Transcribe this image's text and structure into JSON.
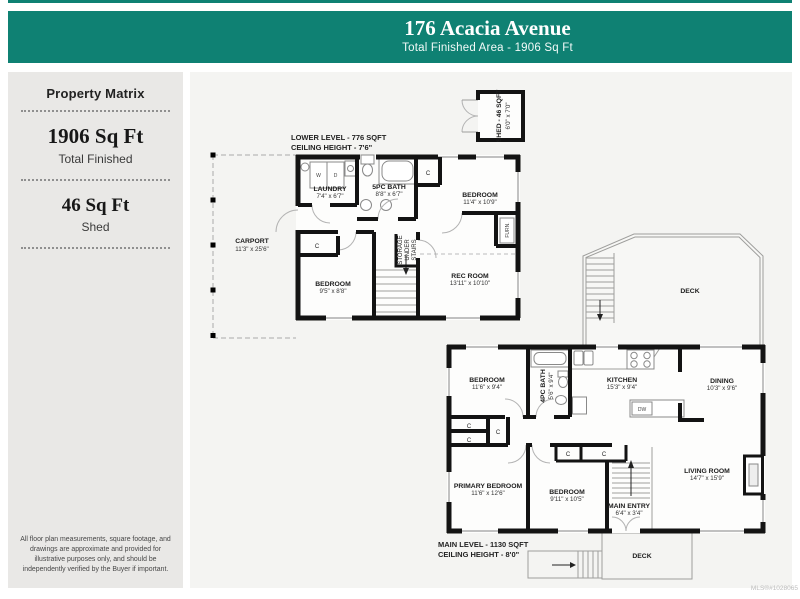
{
  "header": {
    "title": "176 Acacia Avenue",
    "subtitle": "Total Finished Area - 1906 Sq Ft"
  },
  "sidebar": {
    "title": "Property Matrix",
    "stat1_value": "1906 Sq Ft",
    "stat1_label": "Total Finished",
    "stat2_value": "46 Sq Ft",
    "stat2_label": "Shed",
    "disclaimer": "All floor plan measurements, square footage, and drawings are approximate and provided for illustrative purposes only, and should be independently verified by the Buyer if important."
  },
  "shed": {
    "name": "SHED - 46 SQFT",
    "dims": "6'0\" x 7'0\""
  },
  "lower_level": {
    "title": "LOWER LEVEL - 776 SQFT",
    "ceiling": "CEILING HEIGHT - 7'6\"",
    "rooms": {
      "carport": {
        "name": "CARPORT",
        "dims": "11'3\" x 25'6\""
      },
      "laundry": {
        "name": "LAUNDRY",
        "dims": "7'4\" x 6'7\""
      },
      "bath": {
        "name": "5PC BATH",
        "dims": "8'8\" x 6'7\""
      },
      "bedroom1": {
        "name": "BEDROOM",
        "dims": "11'4\" x 10'9\""
      },
      "bedroom2": {
        "name": "BEDROOM",
        "dims": "9'5\" x 8'8\""
      },
      "recroom": {
        "name": "REC ROOM",
        "dims": "13'11\" x 10'10\""
      },
      "storage": {
        "line1": "STORAGE",
        "line2": "UNDER",
        "line3": "STAIRS"
      },
      "furnace": "FURN."
    }
  },
  "main_level": {
    "title": "MAIN LEVEL - 1130 SQFT",
    "ceiling": "CEILING HEIGHT - 8'0\"",
    "rooms": {
      "bedroom1": {
        "name": "BEDROOM",
        "dims": "11'6\" x 9'4\""
      },
      "bath": {
        "name": "4PC BATH",
        "dims": "5'6\" x 9'4\""
      },
      "kitchen": {
        "name": "KITCHEN",
        "dims": "15'3\" x 9'4\""
      },
      "dining": {
        "name": "DINING",
        "dims": "10'3\" x 9'6\""
      },
      "primary": {
        "name": "PRIMARY BEDROOM",
        "dims": "11'6\" x 12'6\""
      },
      "bedroom2": {
        "name": "BEDROOM",
        "dims": "9'11\" x 10'5\""
      },
      "entry": {
        "name": "MAIN ENTRY",
        "dims": "6'4\" x 3'4\""
      },
      "living": {
        "name": "LIVING ROOM",
        "dims": "14'7\" x 15'9\""
      },
      "deck_upper": "DECK",
      "deck_lower": "DECK"
    }
  },
  "labels": {
    "closet": "C",
    "washer": "W",
    "dryer": "D",
    "dishwasher": "DW"
  },
  "footer": {
    "mls": "MLS®#1028065"
  },
  "colors": {
    "accent": "#0f8173"
  }
}
